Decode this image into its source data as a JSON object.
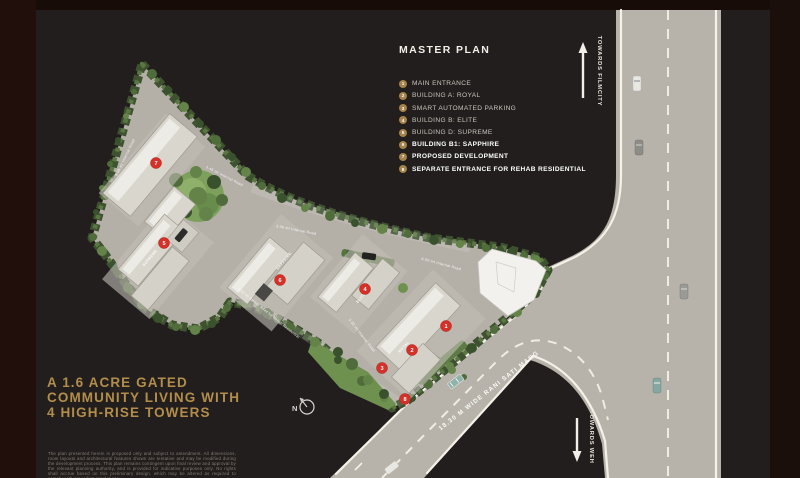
{
  "header": {
    "title": "MASTER PLAN"
  },
  "legend": {
    "items": [
      {
        "number": "1",
        "label": "MAIN ENTRANCE",
        "bold": false
      },
      {
        "number": "2",
        "label": "BUILDING A: ROYAL",
        "bold": false
      },
      {
        "number": "3",
        "label": "SMART AUTOMATED PARKING",
        "bold": false
      },
      {
        "number": "4",
        "label": "BUILDING B: ELITE",
        "bold": false
      },
      {
        "number": "5",
        "label": "BUILDING D: SUPREME",
        "bold": false
      },
      {
        "number": "6",
        "label": "BUILDING B1: SAPPHIRE",
        "bold": true
      },
      {
        "number": "7",
        "label": "PROPOSED DEVELOPMENT",
        "bold": true
      },
      {
        "number": "8",
        "label": "SEPARATE ENTRANCE FOR REHAB RESIDENTIAL",
        "bold": true
      }
    ]
  },
  "directions": {
    "filmcity": "TOWARDS FILMCITY",
    "weh": "TOWARDS WEH"
  },
  "map": {
    "main_road_label": "18.30 M WIDE RANI SATI MARG",
    "north_label": "N",
    "internal_road_labels": [
      "3.05 mt Internal Road",
      "1.45 mt Internal Road",
      "3.00 mt Internal Road",
      "6.00 mt Internal Road",
      "4.50 mt Access Road for Rehab Residential",
      "3.00 mt Internal Road"
    ],
    "building_labels": [
      "SUPREME",
      "SAPPHIRE",
      "ELITE",
      "ROYAL"
    ],
    "markers": [
      "7",
      "5",
      "6",
      "4",
      "1",
      "2",
      "3",
      "8"
    ]
  },
  "headline": {
    "line1": "A 1.6 ACRE GATED",
    "line2": "COMMUNITY LIVING WITH",
    "line3": "4 HIGH-RISE TOWERS"
  },
  "disclaimer": "The plan presented herein is proposed only and subject to amendment. All dimensions, room layouts and architectural features shown are tentative and may be modified during the development process. This plan remains contingent upon final review and approval by the relevant planning authority, and is provided for indicative purposes only. No rights shall accrue based on this preliminary design, which may be altered as required to comply with prevailing regulations.",
  "colors": {
    "accent_gold": "#b38d4b",
    "marker_red": "#d63129",
    "hedge_green": "#3e5230"
  }
}
